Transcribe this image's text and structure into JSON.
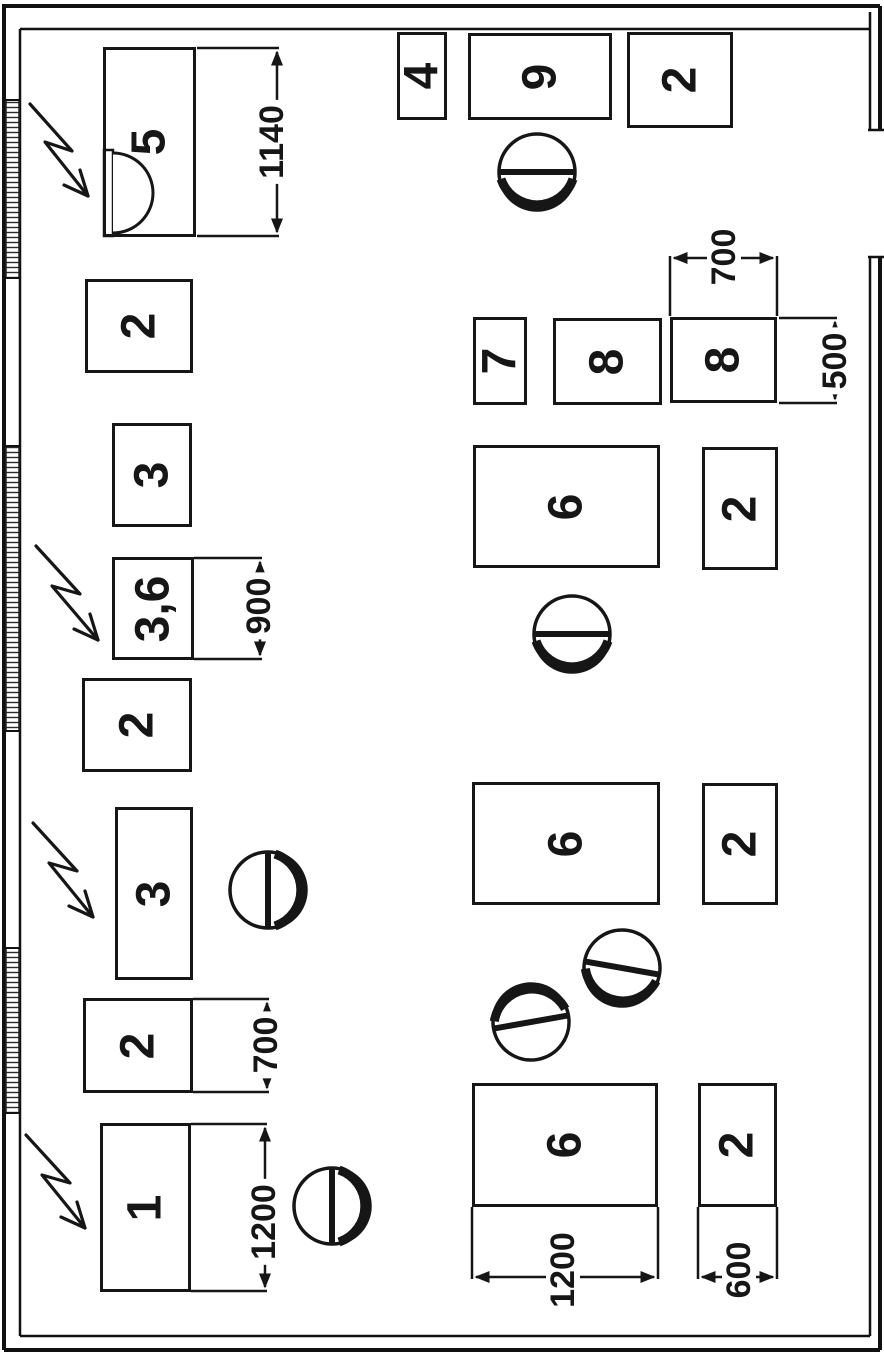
{
  "drawing_title": "workshop equipment layout plan (rotated scan)",
  "machines": [
    {
      "label": "5",
      "dim": "1140"
    },
    {
      "label": "2"
    },
    {
      "label": "3"
    },
    {
      "label": "3,6",
      "dim": "900"
    },
    {
      "label": "2"
    },
    {
      "label": "3"
    },
    {
      "label": "2",
      "dim": "700"
    },
    {
      "label": "1",
      "dim": "1200"
    },
    {
      "label": "4"
    },
    {
      "label": "9"
    },
    {
      "label": "2"
    },
    {
      "label": "7"
    },
    {
      "label": "8"
    },
    {
      "label": "8",
      "dim_w": "700",
      "dim_h": "500"
    },
    {
      "label": "6"
    },
    {
      "label": "2"
    },
    {
      "label": "6"
    },
    {
      "label": "2"
    },
    {
      "label": "6",
      "dim": "1200"
    },
    {
      "label": "2",
      "dim": "600"
    }
  ]
}
